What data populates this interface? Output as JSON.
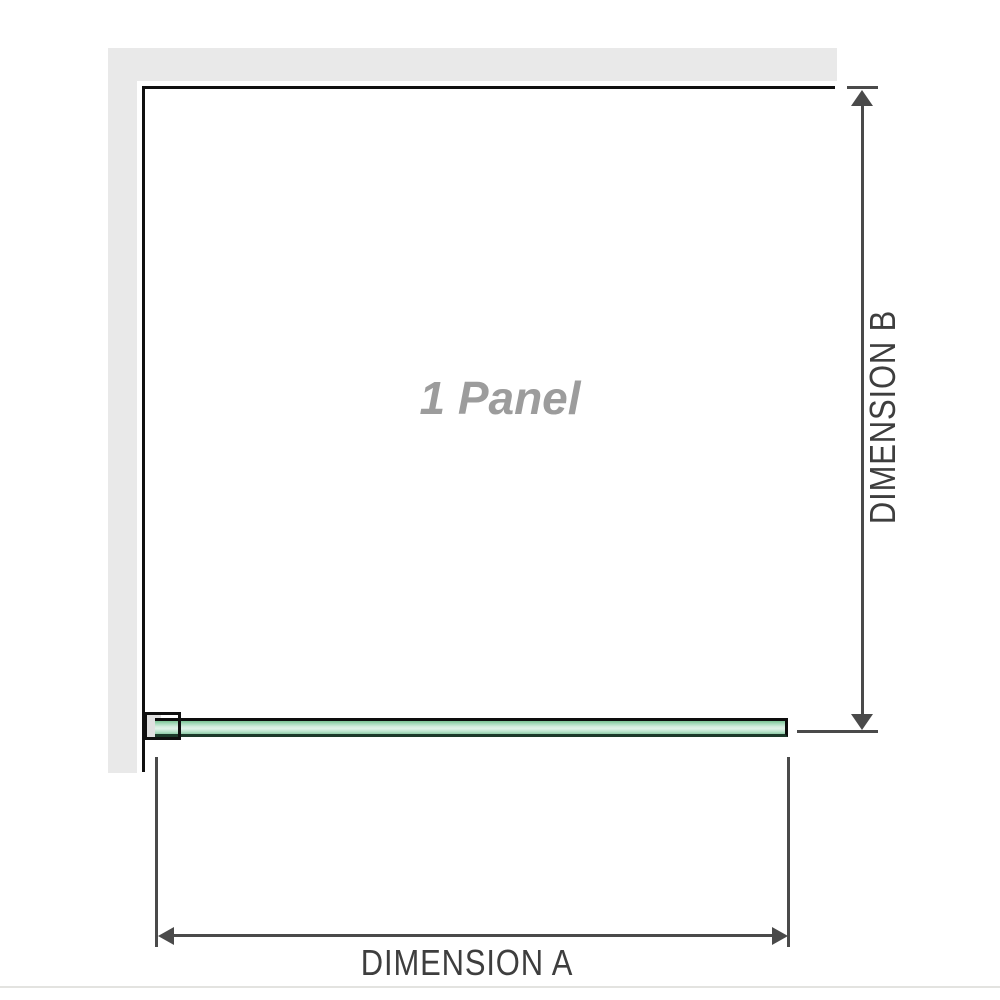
{
  "diagram": {
    "title": "shower-screen-panel-dimension-diagram",
    "panel_label": "1 Panel",
    "dimension_a_label": "DIMENSION A",
    "dimension_b_label": "DIMENSION B"
  },
  "colors": {
    "background": "#ffffff",
    "wall_fill": "#e9e9e9",
    "frame_line": "#101010",
    "dimension_line": "#4a4a4a",
    "dimension_label_text": "#3e3e3e",
    "panel_label_text": "#9c9c9c",
    "glass_fill_light": "#dff2e8",
    "glass_fill_dark": "#79c394",
    "glass_border_top": "#0d0d0d",
    "glass_border_bottom": "#1c3a2a",
    "bracket_pad": "#e0e0e0",
    "baseline": "#e3e3e0"
  }
}
